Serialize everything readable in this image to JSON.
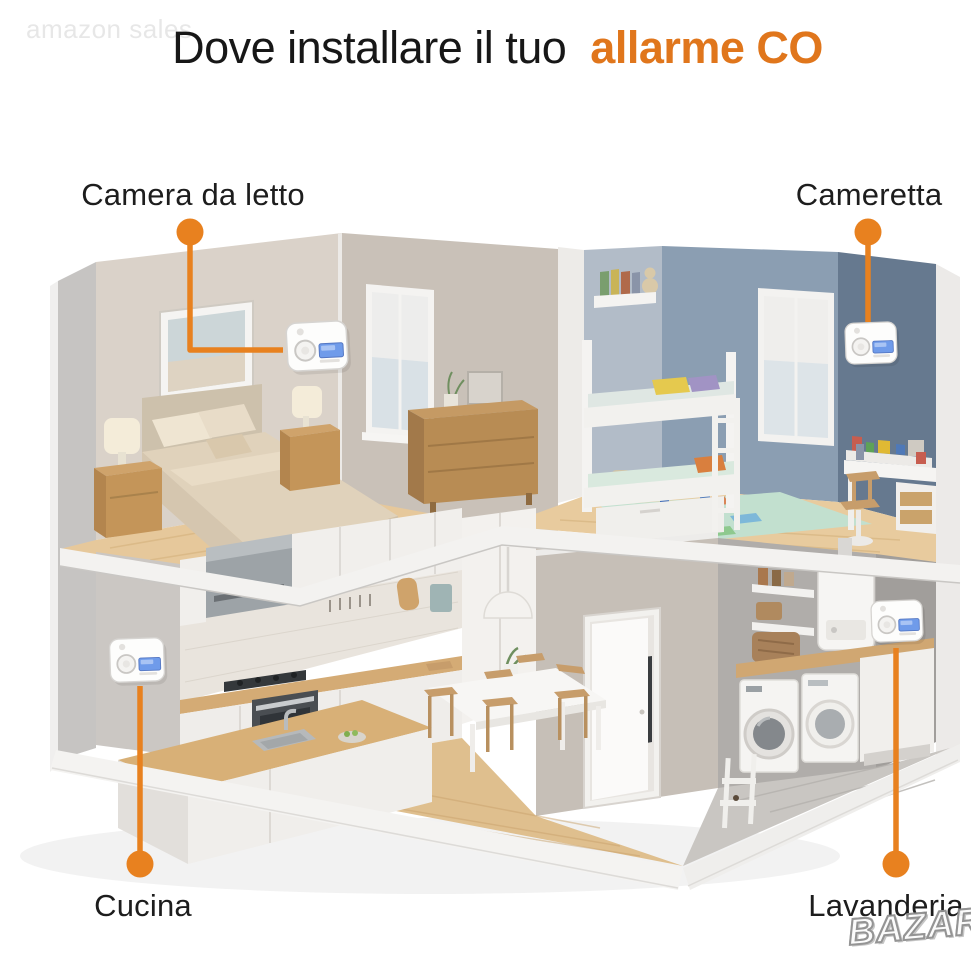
{
  "title": {
    "prefix": "Dove installare il tuo",
    "highlight": "allarme CO"
  },
  "watermarks": {
    "top_left": "amazon sales",
    "bottom_right": "BAZAR"
  },
  "accent_color": "#E8811F",
  "rooms": [
    {
      "id": "bedroom",
      "label": "Camera da letto"
    },
    {
      "id": "kids",
      "label": "Cameretta"
    },
    {
      "id": "kitchen",
      "label": "Cucina"
    },
    {
      "id": "laundry",
      "label": "Lavanderia"
    }
  ]
}
